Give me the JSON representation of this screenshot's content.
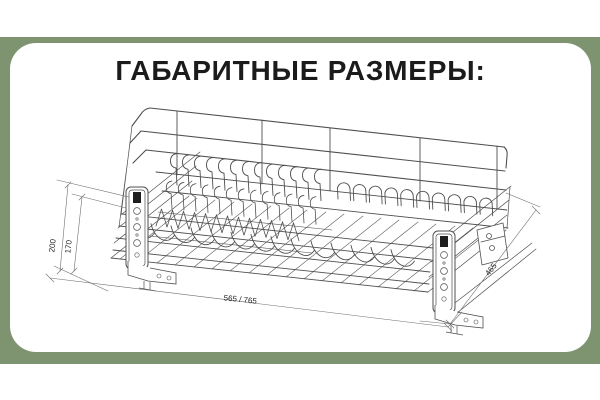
{
  "frame": {
    "color": "#7E9370"
  },
  "panel": {
    "background": "#ffffff"
  },
  "header": {
    "title": "ГАБАРИТНЫЕ РАЗМЕРЫ:",
    "color": "#1b1b1b"
  },
  "drawing": {
    "subject": "isometric wireframe of pull-out dish drying rack with mounting brackets",
    "line_color": "#4f4f4f",
    "dim_color": "#6e6e6e",
    "dimensions": {
      "bracket_height": "200",
      "rack_height": "170",
      "width_options": "565 / 765",
      "depth": "465"
    }
  }
}
